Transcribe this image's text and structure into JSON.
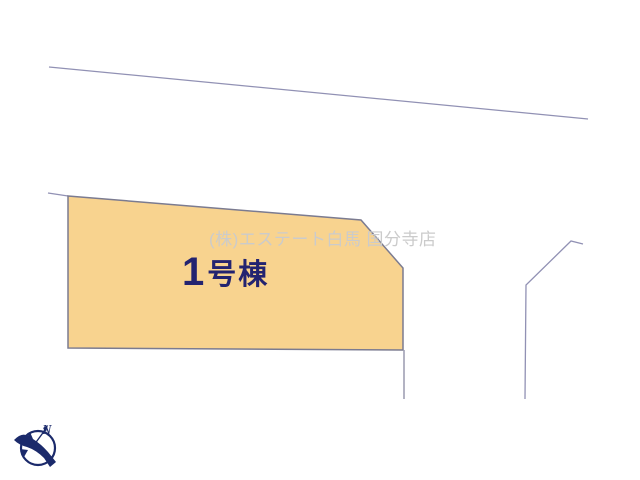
{
  "plan": {
    "watermark": "(株)エステート白馬 国分寺店",
    "parcel": {
      "label_number": "1",
      "label_suffix": "号棟"
    },
    "compass_label": "N"
  },
  "icons": {
    "compass": "north-compass-bird-icon"
  },
  "colors": {
    "background": "#ffffff",
    "parcel_fill": "#f8d38f",
    "parcel_border": "#7b7b90",
    "road_line": "#9191b4",
    "boundary_line": "#a0a0b4",
    "label_text": "#232370",
    "watermark_text": "#cbcbcb",
    "compass": "#1b2a6b"
  }
}
